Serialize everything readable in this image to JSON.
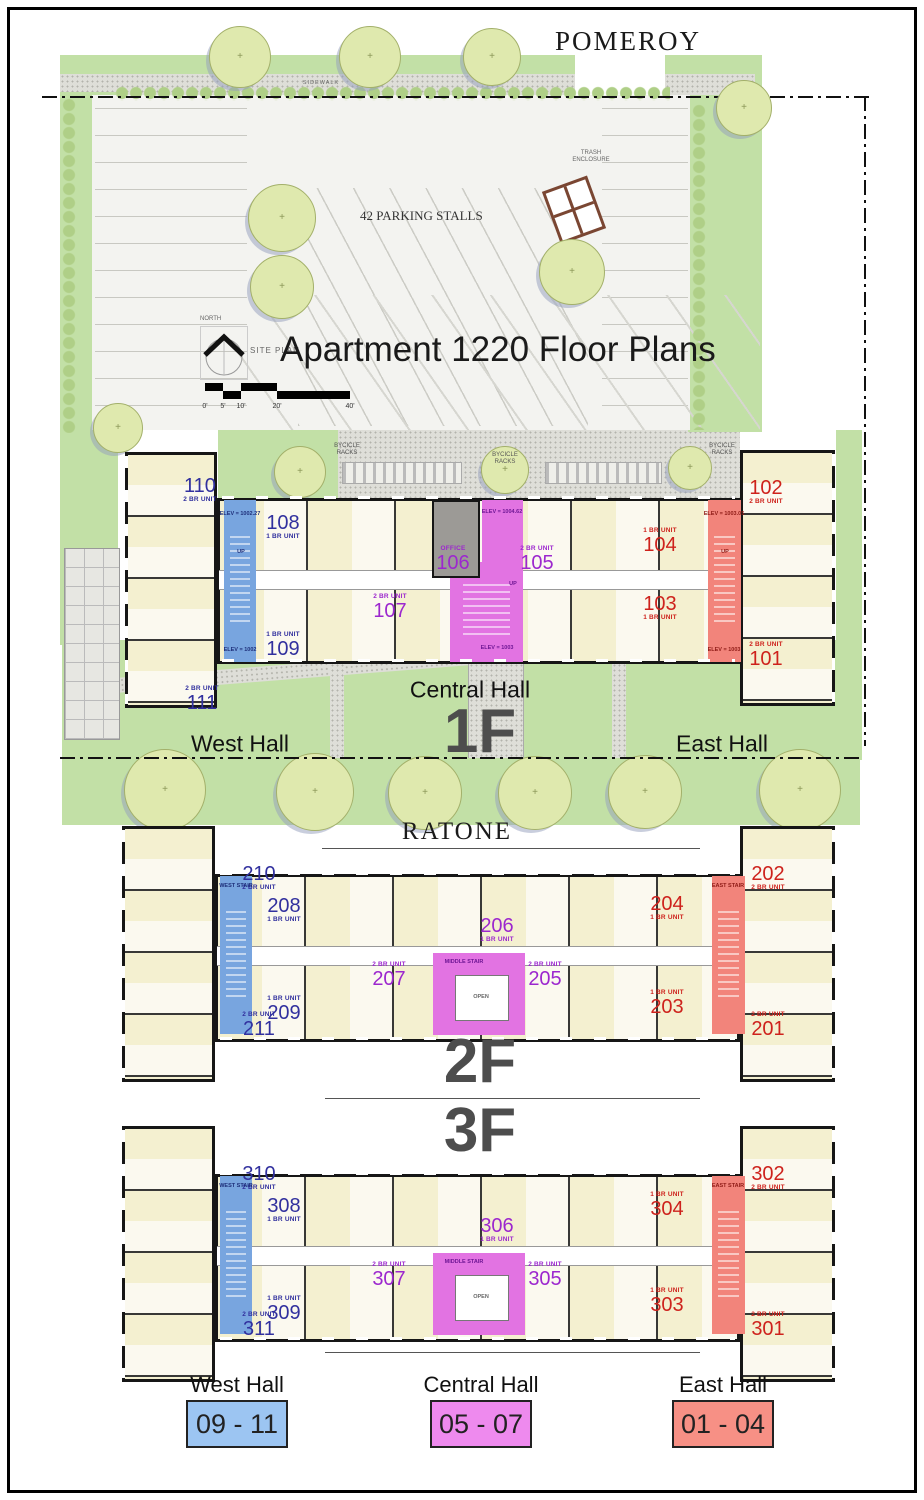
{
  "doc": {
    "title": "Apartment 1220 Floor Plans",
    "street_north": "POMEROY",
    "street_south": "RATONE"
  },
  "site": {
    "north_label": "NORTH",
    "site_plan_label": "SITE PLAN",
    "sidewalk_label": "SIDEWALK",
    "parking_label": "42 PARKING STALLS",
    "trash_label": "TRASH ENCLOSURE",
    "scale_ticks": [
      "0'",
      "5'",
      "10'",
      "20'",
      "40'"
    ]
  },
  "halls": {
    "west": "West Hall",
    "central": "Central Hall",
    "east": "East Hall"
  },
  "colors": {
    "west_zone": "#78A5DF",
    "central_zone": "#E273E2",
    "east_zone": "#F2847B",
    "west_text": "#31309E",
    "central_text": "#9C27CE",
    "east_text": "#CE221C"
  },
  "legend": {
    "items": [
      {
        "hall": "West Hall",
        "units": "09 - 11",
        "color": "#9CC5F2"
      },
      {
        "hall": "Central Hall",
        "units": "05 - 07",
        "color": "#EE8AEE"
      },
      {
        "hall": "East Hall",
        "units": "01 - 04",
        "color": "#F79085"
      }
    ]
  },
  "floors": [
    {
      "id": "1F",
      "label": "1F",
      "bike_racks": [
        {
          "text": "BYCICLE RACKS",
          "x": 347,
          "y": 450
        },
        {
          "text": "BYCICLE RACKS",
          "x": 505,
          "y": 459
        },
        {
          "text": "BYCICLE RACKS",
          "x": 722,
          "y": 450
        }
      ],
      "units": [
        {
          "number": "110",
          "type": "2 BR UNIT",
          "group": "west",
          "order": "nf",
          "x": 200,
          "y": 490
        },
        {
          "number": "108",
          "type": "1 BR UNIT",
          "group": "west",
          "order": "nf",
          "x": 283,
          "y": 527
        },
        {
          "number": "109",
          "type": "1 BR UNIT",
          "group": "west",
          "order": "tf",
          "x": 283,
          "y": 646
        },
        {
          "number": "111",
          "type": "2 BR UNIT",
          "group": "west",
          "order": "tf",
          "x": 202,
          "y": 700
        },
        {
          "number": "107",
          "type": "2 BR UNIT",
          "group": "central",
          "order": "tf",
          "x": 390,
          "y": 608
        },
        {
          "number": "106",
          "type": "OFFICE",
          "group": "central",
          "order": "tf",
          "x": 453,
          "y": 560
        },
        {
          "number": "105",
          "type": "2 BR UNIT",
          "group": "central",
          "order": "tf",
          "x": 537,
          "y": 560
        },
        {
          "number": "104",
          "type": "1 BR UNIT",
          "group": "east",
          "order": "tf",
          "x": 660,
          "y": 542
        },
        {
          "number": "103",
          "type": "1 BR UNIT",
          "group": "east",
          "order": "nf",
          "x": 660,
          "y": 608
        },
        {
          "number": "102",
          "type": "2 BR UNIT",
          "group": "east",
          "order": "nf",
          "x": 766,
          "y": 492
        },
        {
          "number": "101",
          "type": "2 BR UNIT",
          "group": "east",
          "order": "tf",
          "x": 766,
          "y": 656
        }
      ],
      "notes": [
        {
          "text": "ELEV = 1002.27",
          "group": "west",
          "x": 240,
          "y": 514
        },
        {
          "text": "UP",
          "group": "west",
          "x": 241,
          "y": 552
        },
        {
          "text": "ELEV = 1002",
          "group": "west",
          "x": 240,
          "y": 650
        },
        {
          "text": "ELEV = 1004.62",
          "group": "central",
          "x": 502,
          "y": 512
        },
        {
          "text": "UP",
          "group": "central",
          "x": 513,
          "y": 584
        },
        {
          "text": "ELEV = 1003",
          "group": "central",
          "x": 497,
          "y": 648
        },
        {
          "text": "ELEV = 1003.05",
          "group": "east",
          "x": 724,
          "y": 514
        },
        {
          "text": "UP",
          "group": "east",
          "x": 725,
          "y": 552
        },
        {
          "text": "ELEV = 1003",
          "group": "east",
          "x": 724,
          "y": 650
        }
      ]
    },
    {
      "id": "2F",
      "label": "2F",
      "units": [
        {
          "number": "210",
          "type": "2 BR UNIT",
          "group": "west",
          "order": "nf",
          "x": 259,
          "y": 878
        },
        {
          "number": "208",
          "type": "1 BR UNIT",
          "group": "west",
          "order": "nf",
          "x": 284,
          "y": 910
        },
        {
          "number": "209",
          "type": "1 BR UNIT",
          "group": "west",
          "order": "tf",
          "x": 284,
          "y": 1010
        },
        {
          "number": "211",
          "type": "2 BR UNIT",
          "group": "west",
          "order": "tf",
          "x": 259,
          "y": 1026
        },
        {
          "number": "206",
          "type": "1 BR UNIT",
          "group": "central",
          "order": "nf",
          "x": 497,
          "y": 930
        },
        {
          "number": "207",
          "type": "2 BR UNIT",
          "group": "central",
          "order": "tf",
          "x": 389,
          "y": 976
        },
        {
          "number": "205",
          "type": "2 BR UNIT",
          "group": "central",
          "order": "tf",
          "x": 545,
          "y": 976
        },
        {
          "number": "204",
          "type": "1 BR UNIT",
          "group": "east",
          "order": "nf",
          "x": 667,
          "y": 908
        },
        {
          "number": "203",
          "type": "1 BR UNIT",
          "group": "east",
          "order": "tf",
          "x": 667,
          "y": 1004
        },
        {
          "number": "202",
          "type": "2 BR UNIT",
          "group": "east",
          "order": "nf",
          "x": 768,
          "y": 878
        },
        {
          "number": "201",
          "type": "2 BR UNIT",
          "group": "east",
          "order": "tf",
          "x": 768,
          "y": 1026
        }
      ],
      "notes": [
        {
          "text": "WEST STAIR",
          "group": "west",
          "x": 236,
          "y": 886
        },
        {
          "text": "MIDDLE STAIR",
          "group": "central",
          "x": 464,
          "y": 962
        },
        {
          "text": "OPEN",
          "group": "plain",
          "x": 481,
          "y": 997
        },
        {
          "text": "EAST STAIR",
          "group": "east",
          "x": 728,
          "y": 886
        }
      ]
    },
    {
      "id": "3F",
      "label": "3F",
      "units": [
        {
          "number": "310",
          "type": "2 BR UNIT",
          "group": "west",
          "order": "nf",
          "x": 259,
          "y": 1178
        },
        {
          "number": "308",
          "type": "1 BR UNIT",
          "group": "west",
          "order": "nf",
          "x": 284,
          "y": 1210
        },
        {
          "number": "309",
          "type": "1 BR UNIT",
          "group": "west",
          "order": "tf",
          "x": 284,
          "y": 1310
        },
        {
          "number": "311",
          "type": "2 BR UNIT",
          "group": "west",
          "order": "tf",
          "x": 259,
          "y": 1326
        },
        {
          "number": "306",
          "type": "1 BR UNIT",
          "group": "central",
          "order": "nf",
          "x": 497,
          "y": 1230
        },
        {
          "number": "307",
          "type": "2 BR UNIT",
          "group": "central",
          "order": "tf",
          "x": 389,
          "y": 1276
        },
        {
          "number": "305",
          "type": "2 BR UNIT",
          "group": "central",
          "order": "tf",
          "x": 545,
          "y": 1276
        },
        {
          "number": "304",
          "type": "1 BR UNIT",
          "group": "east",
          "order": "tf",
          "x": 667,
          "y": 1206
        },
        {
          "number": "303",
          "type": "1 BR UNIT",
          "group": "east",
          "order": "tf",
          "x": 667,
          "y": 1302
        },
        {
          "number": "302",
          "type": "2 BR UNIT",
          "group": "east",
          "order": "nf",
          "x": 768,
          "y": 1178
        },
        {
          "number": "301",
          "type": "2 BR UNIT",
          "group": "east",
          "order": "tf",
          "x": 768,
          "y": 1326
        }
      ],
      "notes": [
        {
          "text": "WEST STAIR",
          "group": "west",
          "x": 236,
          "y": 1186
        },
        {
          "text": "MIDDLE STAIR",
          "group": "central",
          "x": 464,
          "y": 1262
        },
        {
          "text": "OPEN",
          "group": "plain",
          "x": 481,
          "y": 1297
        },
        {
          "text": "EAST STAIR",
          "group": "east",
          "x": 728,
          "y": 1186
        }
      ]
    }
  ]
}
